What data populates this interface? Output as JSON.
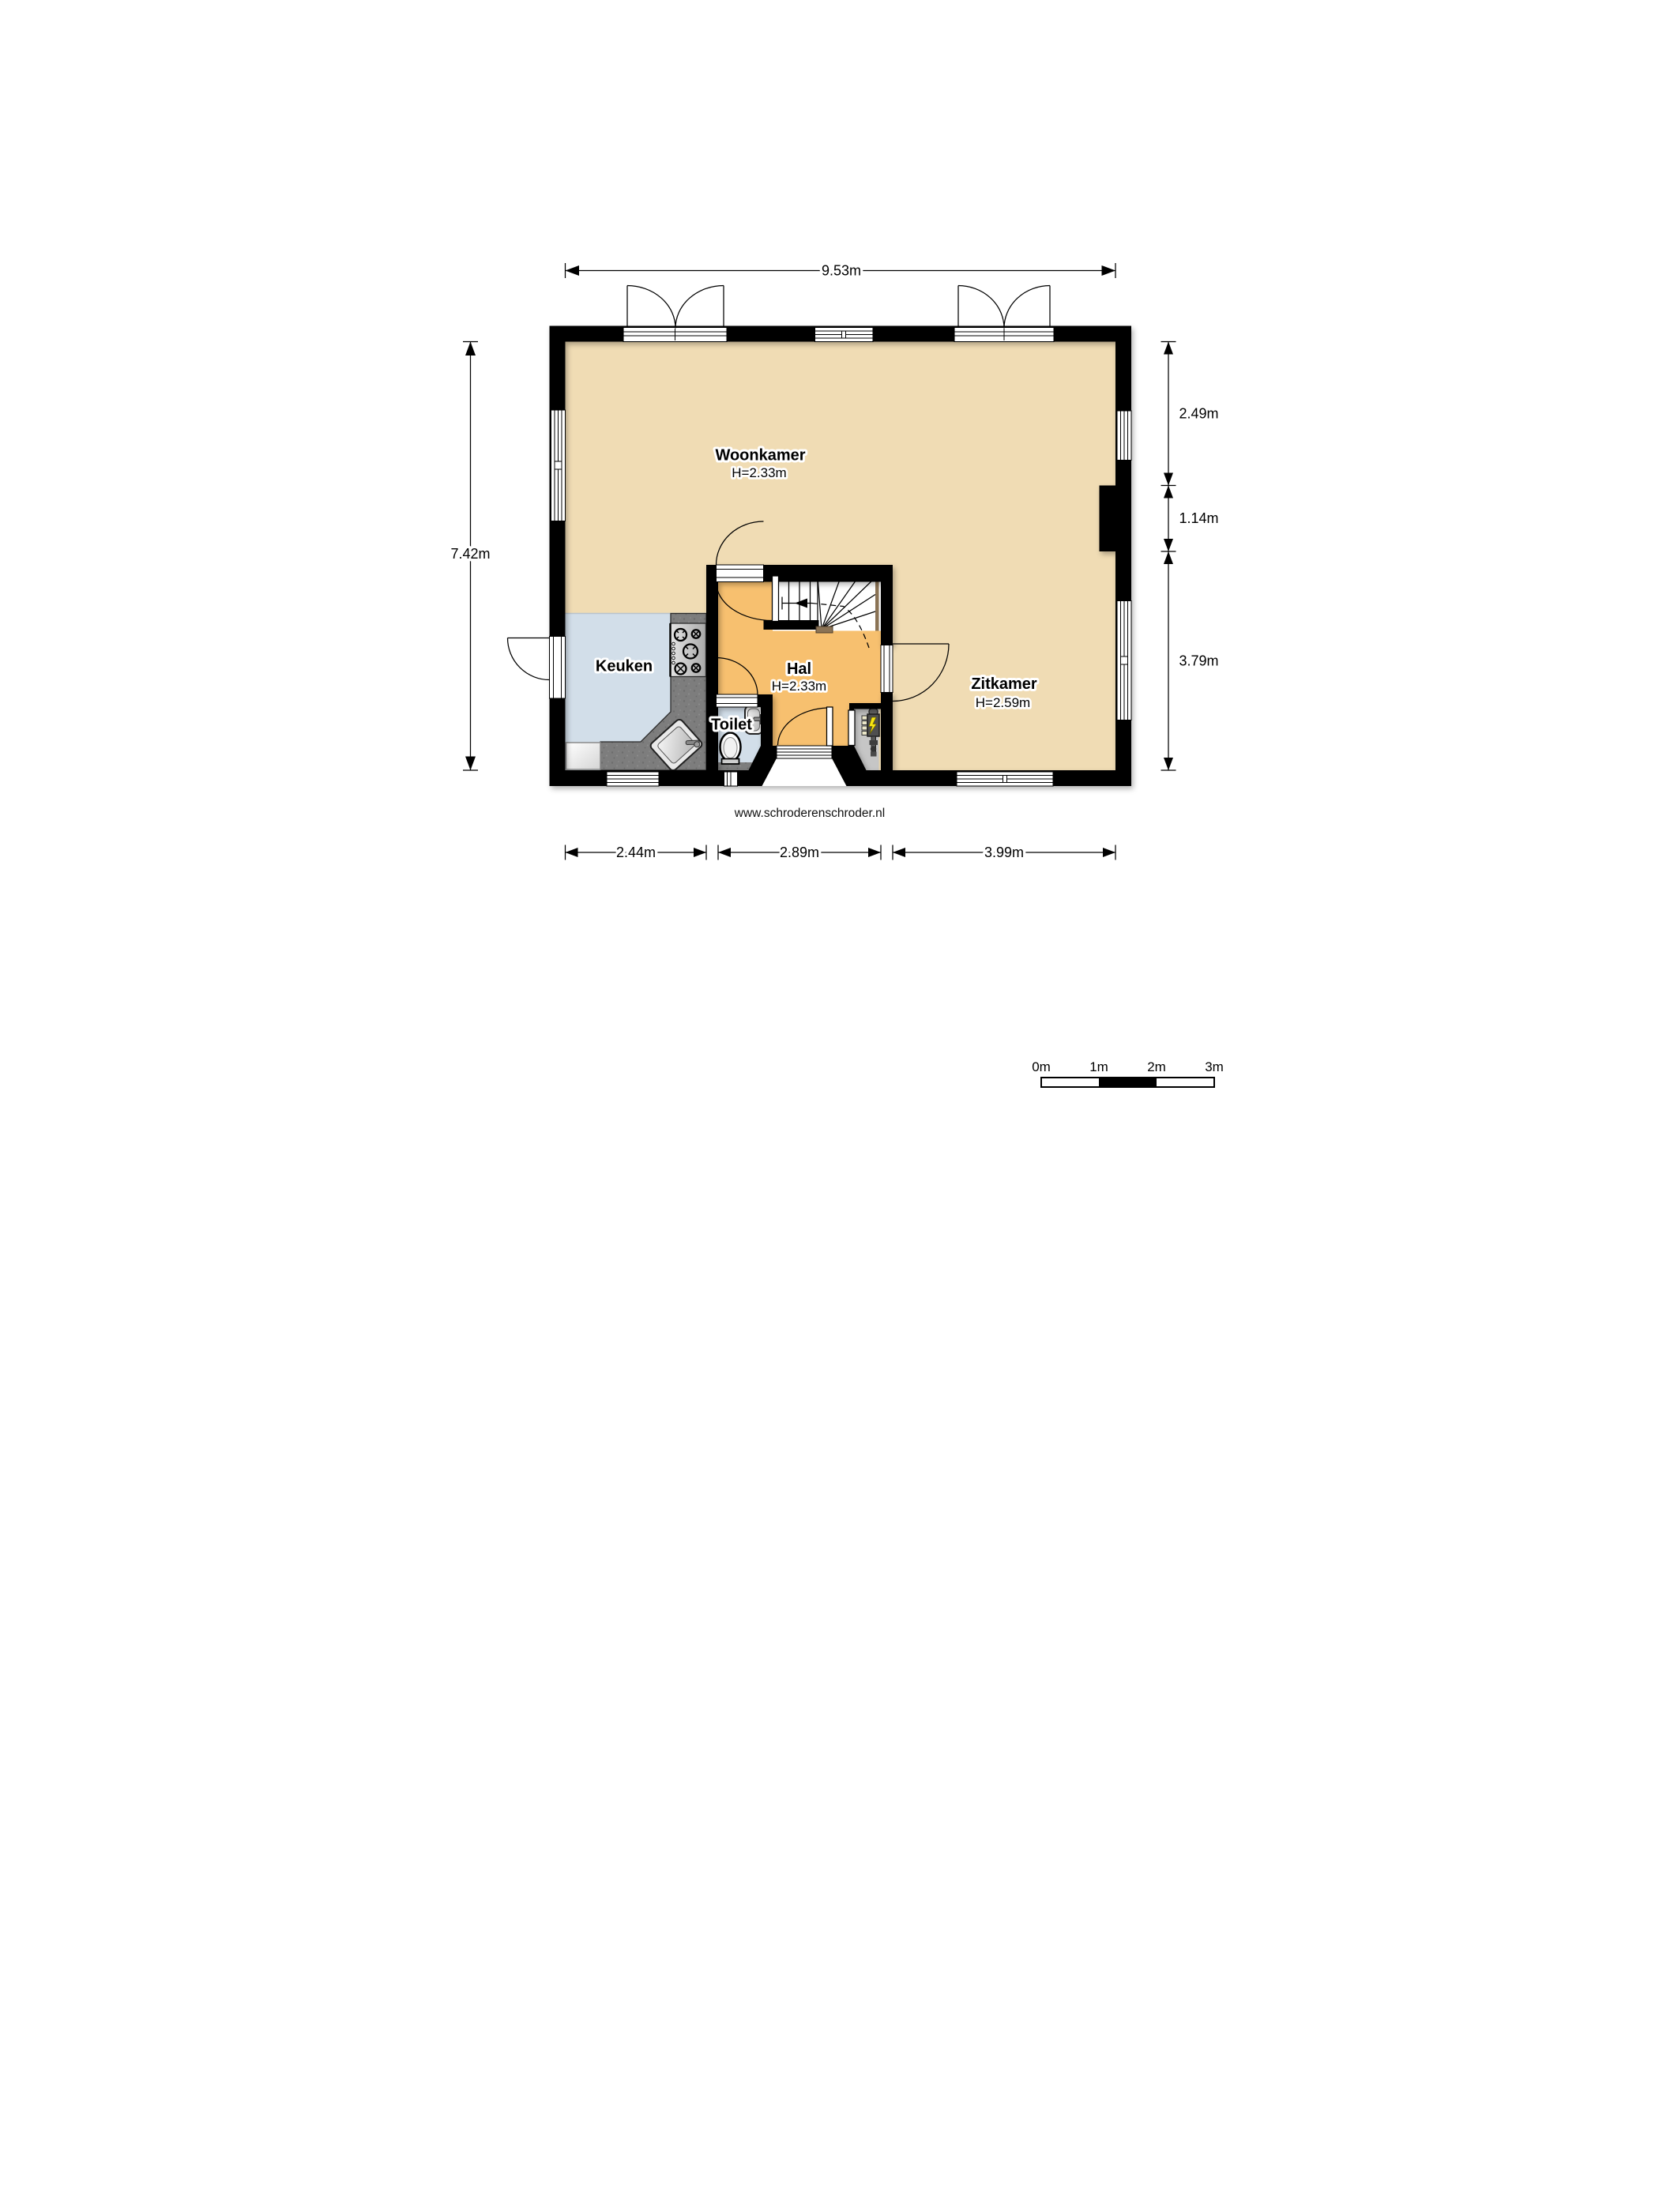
{
  "plan": {
    "rooms": {
      "woonkamer": {
        "label": "Woonkamer",
        "height": "H=2.33m"
      },
      "zitkamer": {
        "label": "Zitkamer",
        "height": "H=2.59m"
      },
      "keuken": {
        "label": "Keuken"
      },
      "hal": {
        "label": "Hal",
        "height": "H=2.33m"
      },
      "toilet": {
        "label": "Toilet"
      }
    },
    "dimensions": {
      "top": "9.53m",
      "left": "7.42m",
      "right": [
        "2.49m",
        "1.14m",
        "3.79m"
      ],
      "bottom": [
        "2.44m",
        "2.89m",
        "3.99m"
      ]
    },
    "website": "www.schroderenschroder.nl",
    "scale_bar": {
      "labels": [
        "0m",
        "1m",
        "2m",
        "3m"
      ]
    },
    "colors": {
      "wall": "#000000",
      "floor_living": "#f0dcb4",
      "floor_hal": "#f7c06f",
      "floor_kitchen": "#d2dee9",
      "floor_meter_closet": "#c6c6c6",
      "counter": "#7d7d7d",
      "stair_wood": "#8b7355",
      "bolt_yellow": "#f7e613"
    }
  }
}
